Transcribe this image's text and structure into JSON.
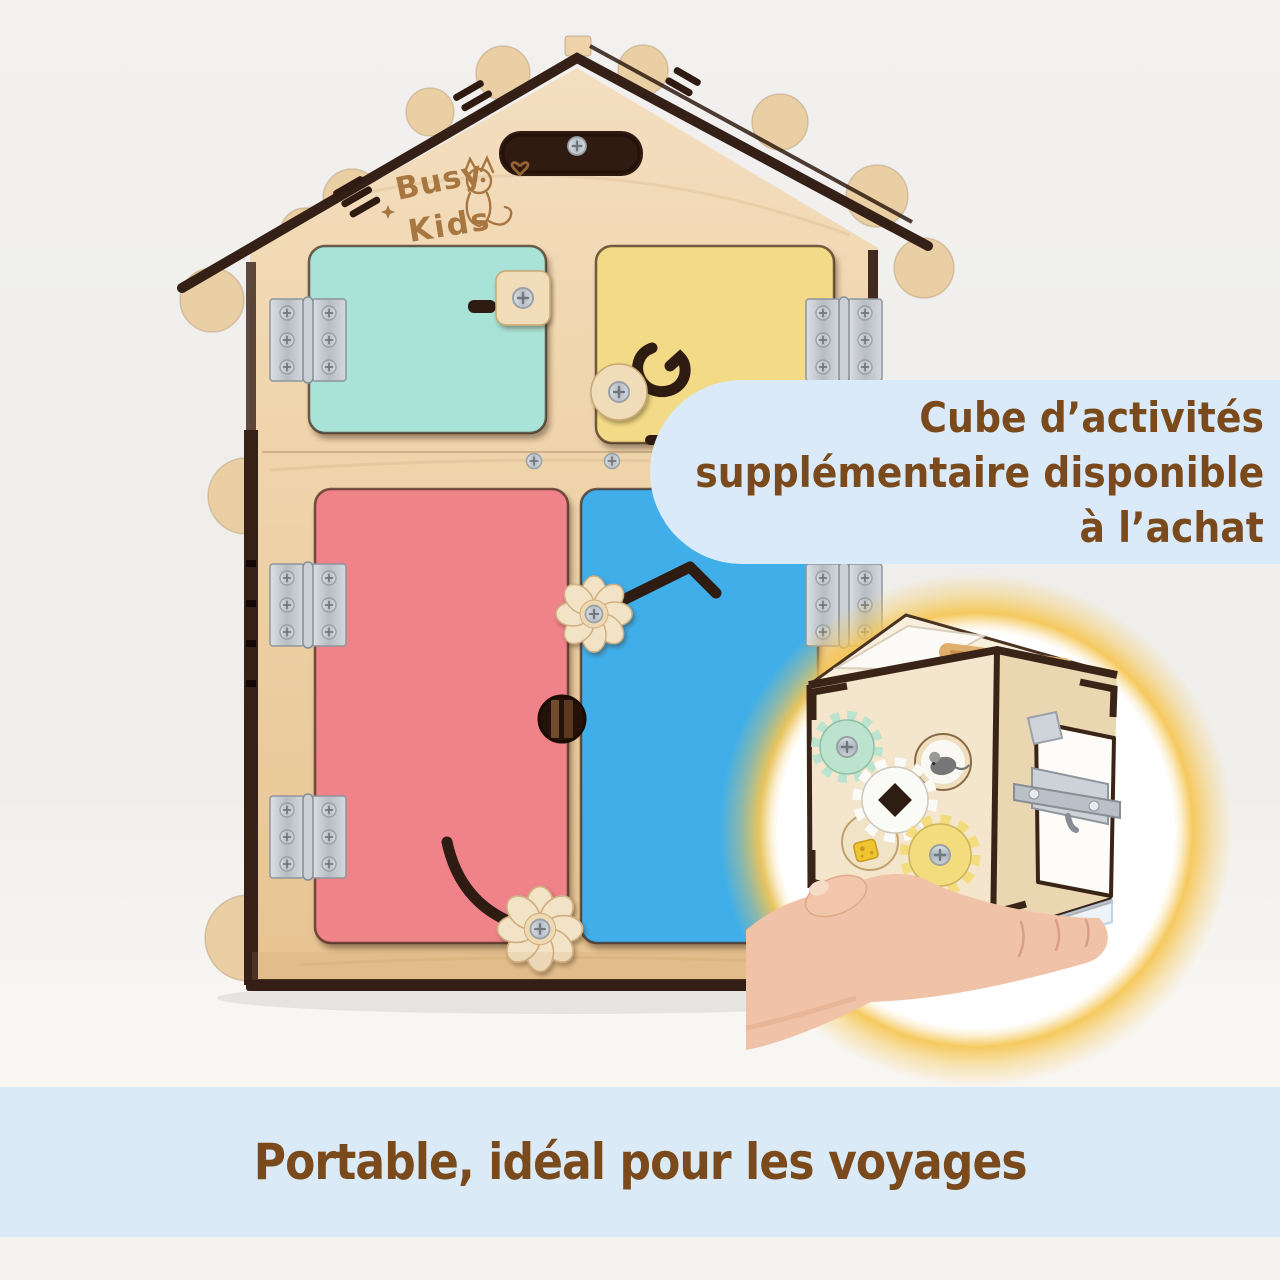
{
  "callout": {
    "line1": "Cube d’activités",
    "line2": "supplémentaire disponible",
    "line3": "à l’achat"
  },
  "banner": {
    "text": "Portable, idéal pour les voyages"
  },
  "brand": {
    "word1": "Busy",
    "word2": "Kids"
  },
  "colors": {
    "background": "#F1F0EE",
    "banner_bg": "#DBEAF7",
    "callout_bg": "#DAEAF8",
    "text_brown": "#7B4A1C",
    "wood_light": "#F2DCB8",
    "wood_mid": "#EDD0A4",
    "wood_dark_edge": "#352017",
    "door_mint": "#A9E2D6",
    "door_yellow": "#F2DA86",
    "door_red": "#F0828A",
    "door_blue": "#41AEE9",
    "hinge_silver": "#C7CCD2",
    "latch_wood": "#F0DCB8",
    "gear_mint": "#BCE3CE",
    "gear_white": "#FAFAF7",
    "gear_yellow": "#F2DC7E",
    "glow_yellow": "#F6C653",
    "skin": "#F0C3A8",
    "cube_front": "#F4E6CC",
    "cube_side": "#EBD6B2",
    "cube_top": "#F8EFDC"
  }
}
